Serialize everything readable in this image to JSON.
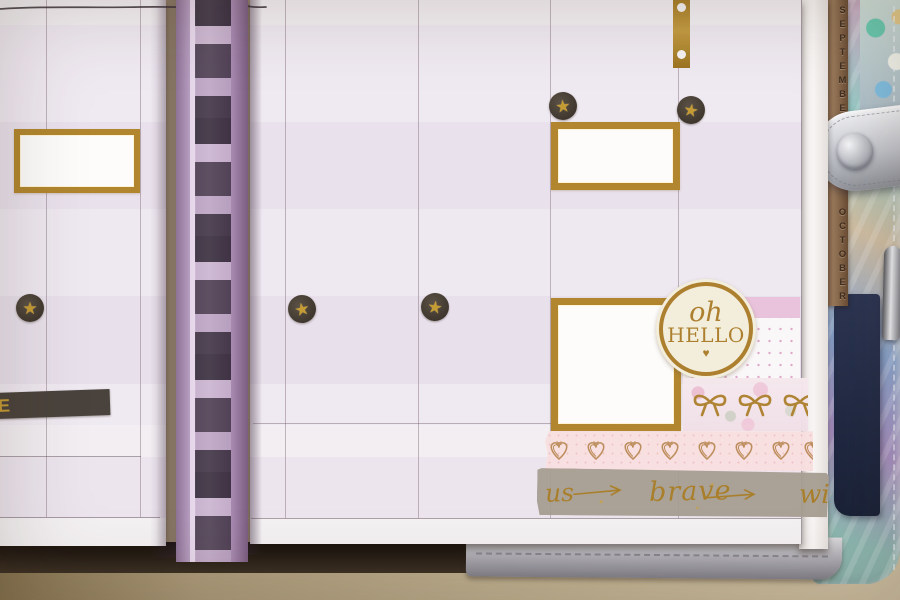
{
  "photo": {
    "subject": "Open disc-bound weekly planner decorated with gold foil stickers and washi tape, silver holographic cover, purple binder discs"
  },
  "stickers": {
    "oh_hello": {
      "word1": "oh",
      "word2": "HELLO",
      "heart_glyph": "♥"
    },
    "star_glyph": "★",
    "label_letter": "E"
  },
  "tabs": {
    "month_top": "SEPTEMBER",
    "month_bottom": "OCTOBER"
  },
  "washi": {
    "script_words": {
      "left_partial": "us",
      "center": "brave",
      "right_partial": "wi"
    }
  },
  "palette": {
    "gold_foil": "#b1862f",
    "page_lavender": "#ece5ee",
    "pink_stripe": "#e9c3dc",
    "disc_purple": "#c99cc6",
    "tape_gray": "#a69d91",
    "tab_bronze": "#87664c",
    "cream": "#f3eedc",
    "navy_insert": "#232c47",
    "table_tan": "#b3a284"
  }
}
